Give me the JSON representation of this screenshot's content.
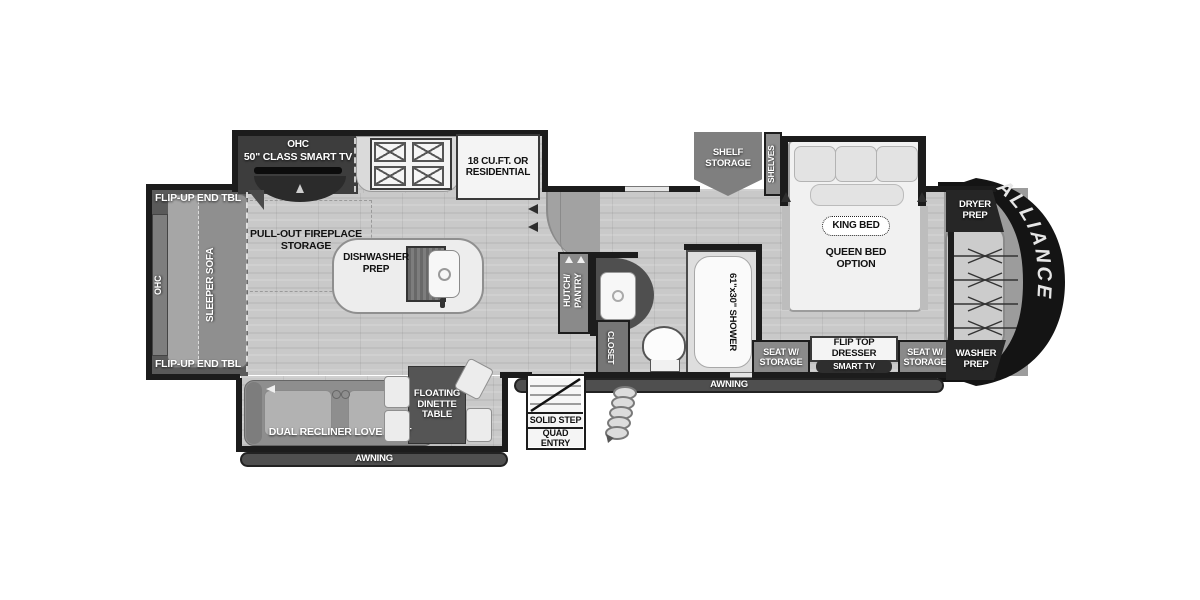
{
  "plan": {
    "brand": "ALLIANCE",
    "colors": {
      "wall": "#1c1c1c",
      "floor": "#c9c9c9",
      "slide_dark": "#3d3d3d",
      "label_gray": "#8a8a8a",
      "cap_black": "#141414",
      "awning_bar": "#4f4f4f"
    },
    "living": {
      "ohc_tv": "OHC",
      "smart_tv_50": "50\" CLASS SMART TV",
      "fireplace_storage": "PULL-OUT FIREPLACE STORAGE",
      "flip_up_end_tbl_top": "FLIP-UP END TBL",
      "flip_up_end_tbl_bottom": "FLIP-UP END TBL",
      "ohc_sofa": "OHC",
      "sleeper_sofa": "SLEEPER SOFA",
      "dual_recliner": "DUAL RECLINER LOVE SEAT",
      "dinette": "FLOATING DINETTE TABLE",
      "awning": "AWNING"
    },
    "kitchen": {
      "fridge": "18 CU.FT. OR RESIDENTIAL",
      "dishwasher_prep": "DISHWASHER PREP"
    },
    "entry": {
      "solid_step": "SOLID STEP",
      "quad_entry": "QUAD ENTRY",
      "awning": "AWNING"
    },
    "bath": {
      "hutch_pantry": "HUTCH/ PANTRY",
      "closet": "CLOSET",
      "shower": "61\"x30\" SHOWER"
    },
    "bedroom": {
      "shelf_storage": "SHELF STORAGE",
      "shelves": "SHELVES",
      "king_bed": "KING BED",
      "queen_bed_option": "QUEEN BED OPTION",
      "seat_w_storage_left": "SEAT W/ STORAGE",
      "flip_top_dresser": "FLIP TOP DRESSER",
      "smart_tv": "SMART TV",
      "seat_w_storage_right": "SEAT W/ STORAGE"
    },
    "front": {
      "dryer_prep": "DRYER PREP",
      "washer_prep": "WASHER PREP"
    }
  }
}
